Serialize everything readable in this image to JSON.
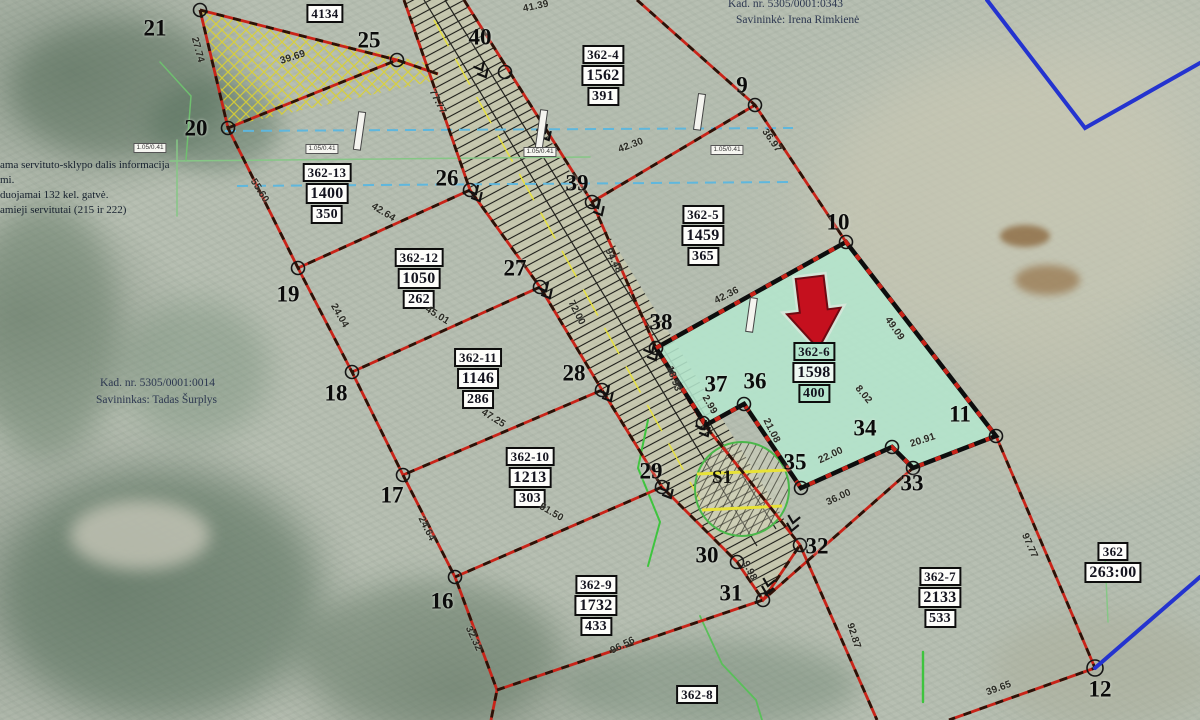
{
  "texts": {
    "top_right": [
      "Kad. nr. 5305/0001:0343",
      "Savininkė: Irena Rimkienė"
    ],
    "left_info": [
      "ama servituto-sklypo dalis informacija",
      "mi.",
      "duojamai 132 kel. gatvė.",
      "amieji servitutai (215 ir 222)"
    ],
    "left_owner": [
      "Kad. nr. 5305/0001:0014",
      "Savininkas: Tadas Šurplys"
    ],
    "s1": "S1"
  },
  "plots": [
    {
      "r1": "4134",
      "x": 325,
      "y": 3
    },
    {
      "r1": "362-4",
      "r2": "1562",
      "r3": "391",
      "x": 603,
      "y": 44
    },
    {
      "r1": "362-13",
      "r2": "1400",
      "r3": "350",
      "x": 327,
      "y": 162
    },
    {
      "r1": "362-12",
      "r2": "1050",
      "r3": "262",
      "x": 419,
      "y": 247
    },
    {
      "r1": "362-5",
      "r2": "1459",
      "r3": "365",
      "x": 703,
      "y": 204
    },
    {
      "r1": "362-6",
      "r2": "1598",
      "r3": "400",
      "x": 814,
      "y": 341,
      "hl": true
    },
    {
      "r1": "362-11",
      "r2": "1146",
      "r3": "286",
      "x": 478,
      "y": 347
    },
    {
      "r1": "362-10",
      "r2": "1213",
      "r3": "303",
      "x": 530,
      "y": 446
    },
    {
      "r1": "362-9",
      "r2": "1732",
      "r3": "433",
      "x": 596,
      "y": 574
    },
    {
      "r1": "362-7",
      "r2": "2133",
      "r3": "533",
      "x": 940,
      "y": 566
    },
    {
      "r1": "362",
      "r2": "263:00",
      "x": 1113,
      "y": 541
    },
    {
      "r1": "362-8",
      "x": 697,
      "y": 684
    }
  ],
  "vertices": [
    {
      "n": "21",
      "x": 155,
      "y": 28
    },
    {
      "n": "25",
      "x": 369,
      "y": 40
    },
    {
      "n": "40",
      "x": 480,
      "y": 37
    },
    {
      "n": "9",
      "x": 742,
      "y": 85
    },
    {
      "n": "20",
      "x": 196,
      "y": 128
    },
    {
      "n": "26",
      "x": 447,
      "y": 178
    },
    {
      "n": "39",
      "x": 577,
      "y": 183
    },
    {
      "n": "10",
      "x": 838,
      "y": 222
    },
    {
      "n": "19",
      "x": 288,
      "y": 294
    },
    {
      "n": "27",
      "x": 515,
      "y": 268
    },
    {
      "n": "38",
      "x": 661,
      "y": 322
    },
    {
      "n": "28",
      "x": 574,
      "y": 373
    },
    {
      "n": "37",
      "x": 716,
      "y": 384
    },
    {
      "n": "36",
      "x": 755,
      "y": 381
    },
    {
      "n": "18",
      "x": 336,
      "y": 393
    },
    {
      "n": "34",
      "x": 865,
      "y": 428
    },
    {
      "n": "11",
      "x": 960,
      "y": 414
    },
    {
      "n": "17",
      "x": 392,
      "y": 495
    },
    {
      "n": "29",
      "x": 651,
      "y": 471
    },
    {
      "n": "35",
      "x": 795,
      "y": 462
    },
    {
      "n": "33",
      "x": 912,
      "y": 483
    },
    {
      "n": "16",
      "x": 442,
      "y": 601
    },
    {
      "n": "30",
      "x": 707,
      "y": 555
    },
    {
      "n": "32",
      "x": 817,
      "y": 546
    },
    {
      "n": "31",
      "x": 731,
      "y": 593
    },
    {
      "n": "12",
      "x": 1100,
      "y": 689
    }
  ],
  "measurements": [
    {
      "t": "41.39",
      "x": 536,
      "y": 7,
      "r": -12
    },
    {
      "t": "39.69",
      "x": 293,
      "y": 58,
      "r": -18
    },
    {
      "t": "27.74",
      "x": 197,
      "y": 50,
      "r": 75
    },
    {
      "t": "77.77",
      "x": 437,
      "y": 102,
      "r": 63
    },
    {
      "t": "55.60",
      "x": 259,
      "y": 191,
      "r": 58
    },
    {
      "t": "42.64",
      "x": 383,
      "y": 213,
      "r": 32
    },
    {
      "t": "45.01",
      "x": 437,
      "y": 316,
      "r": 32
    },
    {
      "t": "94.48",
      "x": 613,
      "y": 261,
      "r": 63
    },
    {
      "t": "72.00",
      "x": 576,
      "y": 313,
      "r": 63
    },
    {
      "t": "24.04",
      "x": 339,
      "y": 316,
      "r": 60
    },
    {
      "t": "47.25",
      "x": 493,
      "y": 419,
      "r": 32
    },
    {
      "t": "18.93",
      "x": 673,
      "y": 379,
      "r": 70
    },
    {
      "t": "2.99",
      "x": 709,
      "y": 405,
      "r": 60
    },
    {
      "t": "42.36",
      "x": 727,
      "y": 296,
      "r": -27
    },
    {
      "t": "36.97",
      "x": 771,
      "y": 141,
      "r": 55
    },
    {
      "t": "42.30",
      "x": 631,
      "y": 146,
      "r": -20
    },
    {
      "t": "49.09",
      "x": 894,
      "y": 329,
      "r": 55
    },
    {
      "t": "8.02",
      "x": 863,
      "y": 395,
      "r": 50
    },
    {
      "t": "20.91",
      "x": 923,
      "y": 441,
      "r": -18
    },
    {
      "t": "22.00",
      "x": 831,
      "y": 456,
      "r": -25
    },
    {
      "t": "36.00",
      "x": 839,
      "y": 498,
      "r": -25
    },
    {
      "t": "21.08",
      "x": 771,
      "y": 431,
      "r": 63
    },
    {
      "t": "51.50",
      "x": 551,
      "y": 513,
      "r": 30
    },
    {
      "t": "24.64",
      "x": 426,
      "y": 529,
      "r": 63
    },
    {
      "t": "32.32",
      "x": 473,
      "y": 639,
      "r": 65
    },
    {
      "t": "96.56",
      "x": 623,
      "y": 646,
      "r": -27
    },
    {
      "t": "92.87",
      "x": 853,
      "y": 636,
      "r": 72
    },
    {
      "t": "97.77",
      "x": 1029,
      "y": 546,
      "r": 66
    },
    {
      "t": "39.65",
      "x": 999,
      "y": 689,
      "r": -20
    },
    {
      "t": "9.98",
      "x": 749,
      "y": 571,
      "r": 63
    }
  ],
  "utility_labels": [
    {
      "t": "1.05/0.41",
      "x": 150,
      "y": 148
    },
    {
      "t": "1.05/0.41",
      "x": 322,
      "y": 149
    },
    {
      "t": "1.05/0.41",
      "x": 540,
      "y": 152
    },
    {
      "t": "1.05/0.41",
      "x": 727,
      "y": 150
    }
  ],
  "colors": {
    "highlight": "#b4e6cd",
    "boundary_red": "#c92318",
    "plot_outline": "#0d0d0d",
    "water_blue": "#2433cf",
    "arrow_red": "#c5101e"
  }
}
